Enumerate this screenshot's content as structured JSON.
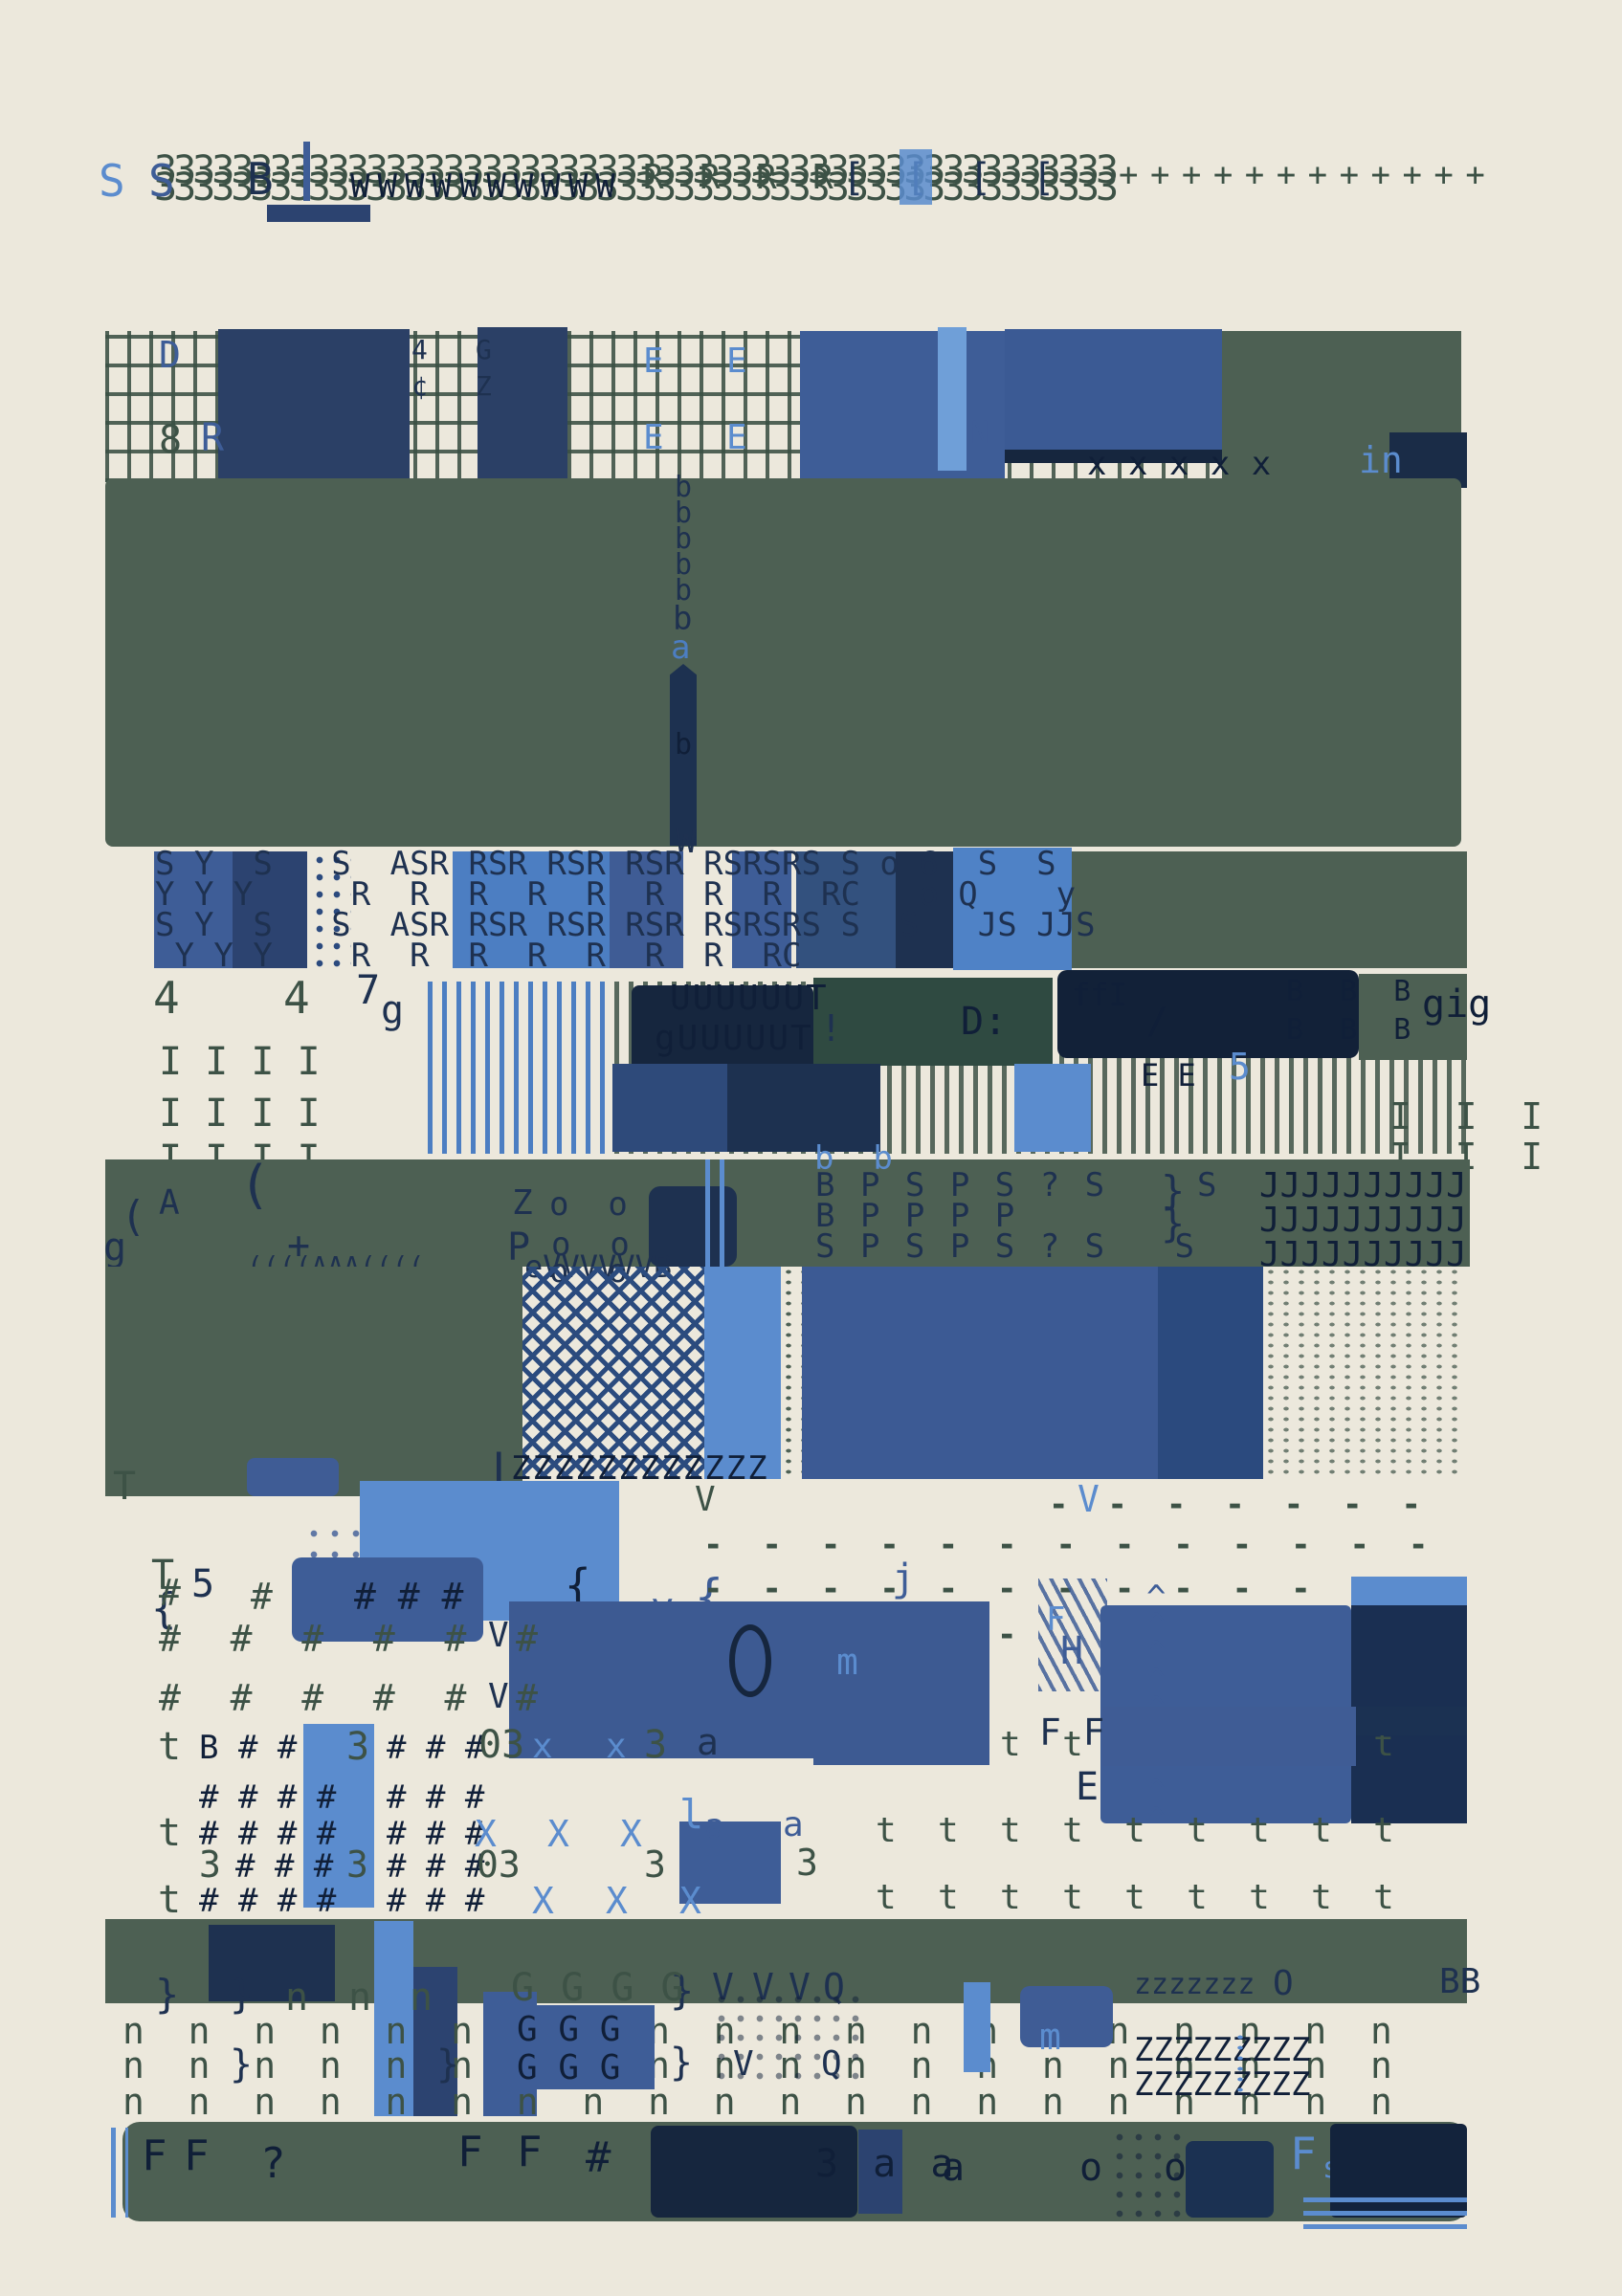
{
  "title": "abstract typewriter artwork",
  "palette": {
    "cream": "#ece8dc",
    "green": "#4d6053",
    "green_text": "#3d5246",
    "navy": "#1e3150",
    "navy_deep": "#101f38",
    "steel": "#3e5d97",
    "blue": "#4c7ec2",
    "sky": "#5b8cce",
    "blue_dark": "#2c4370"
  },
  "top_row": {
    "threes_a": "33333333333333333333333333333333333333333333333333",
    "threes_b": "33333333333333333333333333333333333333333333333333",
    "s1": "S",
    "s2": "S",
    "b": "B",
    "w_run": "WWWWWWWWWW",
    "r_run": "R  R  R  R",
    "brackets": "[ [ [ [",
    "plus_run": "+ + + + + + + + + + + +"
  },
  "band1": {
    "d": "D",
    "eight": "8",
    "r": "R",
    "four": "4",
    "g": "G",
    "cent": "¢",
    "z": "Z",
    "e1": "E",
    "e2": "E",
    "e3": "E",
    "e4": "E",
    "n": "N",
    "x_run": "x x x x x",
    "in_label": "in"
  },
  "green_field": {
    "b_stack": "b\nb\nb\nb\nb",
    "b_mid": "b",
    "a_mid": "a",
    "b_low": "b"
  },
  "rs_band": {
    "w": "W",
    "row1": "S Y  S   S  ASR RSR RSR RSR RSRSRS S o 6  S  S",
    "row2": "Y Y Y     R  R  R  R  R  R  R  R  RC   o Q    y",
    "row3": "S Y  S   S  ASR RSR RSR RSR RSRSRS S  S   JS JJS",
    "row4": " Y Y Y    R  R  R  R  R  R  R  RC"
  },
  "i_band": {
    "four1": "4",
    "four2": "4",
    "seven": "7",
    "g": "g",
    "i_rows": [
      "I I I I",
      "I I I I",
      "I I I I"
    ],
    "u1": "UUUUUUT",
    "u2": "gUUUUUT",
    "d_colon": "D:",
    "ff": "ffI",
    "slash": "/",
    "ee": "E E",
    "five_blue": "5",
    "b_cols": "B B B",
    "b_cols2": "B B B",
    "gig": "gig",
    "bang": "!",
    "eights": "8",
    "five3": "5",
    "i_right": [
      "I  I  I",
      "I  I  I"
    ]
  },
  "band2": {
    "a": "A",
    "g": "g",
    "paren1": "(",
    "paren2": "(",
    "plus": "+",
    "z": "Z",
    "p": "P",
    "oo": [
      "o  o",
      "o  o",
      "o  o"
    ],
    "rows": [
      "B P S P S ? S    S",
      "B P P P P",
      "S P S P S ? S   S     t"
    ],
    "brace1": "}",
    "brace2": "}",
    "j_rows": [
      "JJJJJJJJJJ",
      "JJJJJJJJJJ",
      "JJJJJJJJJJ"
    ],
    "bb": "b  b",
    "evv": "eVVVVVVB",
    "wiggle": "((((AAA(((("
  },
  "tz": {
    "t1": "T",
    "bar": "|",
    "z_run": "ZZZZZZZZZZZZ",
    "t2": "T",
    "brace_l": "{",
    "brace_m1": "{",
    "brace_m2": "{",
    "brace_s": "{",
    "y": "y",
    "brace_y": "{",
    "v_green": "V",
    "v_blue": "V",
    "dash_rows": [
      "-  -  -  -  -  -  -",
      "-  -  -  -  -  -  -  -  -  -  -  -  -",
      "-  -  -  -  -  -  -  -  -  -  -  -  -",
      "-  -  -  -  -  -"
    ]
  },
  "hash_zone": {
    "h1a": "#",
    "five": "5",
    "h1b": "#",
    "h1c": "# # #",
    "row2": "#  #  #  #  #  #",
    "row3": "#  #  #  #  #  #",
    "v1": "V",
    "v2": "V",
    "j": "j",
    "h": "H",
    "f_sky": "F",
    "ff": "F F",
    "e": "E",
    "m": "m",
    "chevrons": "^\n^\n^\n^\n^\n^\n^\n^\n^"
  },
  "t_zone": {
    "rowA_t": "t",
    "rowA_b": "B # # #",
    "rowA_3": "3",
    "rowA_h": "# # #",
    "rowA_03": "03",
    "rowA_x1": "x",
    "rowA_x2": "x",
    "rowA_33": "3",
    "rowA_a": "a",
    "rowB": "# # # #",
    "rowB2": "# # #",
    "rowC_t": "t",
    "rowC_h": "# # # #",
    "rowC_h2": "# # #",
    "rowC_x": [
      "X",
      "X",
      "X"
    ],
    "rowC_l": "l",
    "rowC_a1": "a",
    "rowC_a2": "a",
    "rowD_3a": "3",
    "rowD": "# # #",
    "rowD_3": "3",
    "rowD_h": "# # #",
    "rowD_03": "03",
    "rowD_3b": "3",
    "rowD_3c": "3",
    "rowE_t": "t",
    "rowE_h": "# # # #",
    "rowE_h2": "# # #",
    "rowE_x": [
      "X",
      "X",
      "X"
    ],
    "t_grid": [
      "t  t  t  t  t  t  t  t  t",
      "t  t  t  t  t  t  t  t  t",
      "t  t  t  t  t  t  t  t  t"
    ]
  },
  "n_zone": {
    "spec": {
      "brace1": "}",
      "brace2": "}",
      "n1": "n",
      "n2": "n",
      "n3": "n",
      "brace3": "}",
      "g_run": "G G G G",
      "v1": "V",
      "v2": "V",
      "v3": "V",
      "q": "Q",
      "z_small": "zzzzzzz",
      "o": "O",
      "bb": "BB"
    },
    "n_rows": [
      "n  n  n  n  n  n  n  n  n  n  n  n  n  n  n  n  n  n  n  n",
      "n  n  n  n  n  n  n  n  n  n  n  n  n  n  n  n  n  n  n  n",
      "n  n  n  n  n  n  n  n  n  n  n  n  n  n  n  n  n  n  n  n"
    ],
    "g_block": [
      "G G G",
      "G G G"
    ],
    "m": "m",
    "braces": [
      "}",
      "}",
      "}"
    ],
    "z_rows": [
      "ZZZZZZ",
      "ZZZ",
      "ZZZZZZ",
      "ZZZ"
    ],
    "v_over": "V",
    "q2": "Q"
  },
  "bottom_band": {
    "f1": "F",
    "f2": "F",
    "q": "?",
    "f3": "F",
    "f4": "F",
    "hash": "#",
    "triple_a": "3 a a",
    "a2": "a",
    "o1": "o",
    "o2": "o",
    "f_sky": "F",
    "s_sky": "s"
  }
}
